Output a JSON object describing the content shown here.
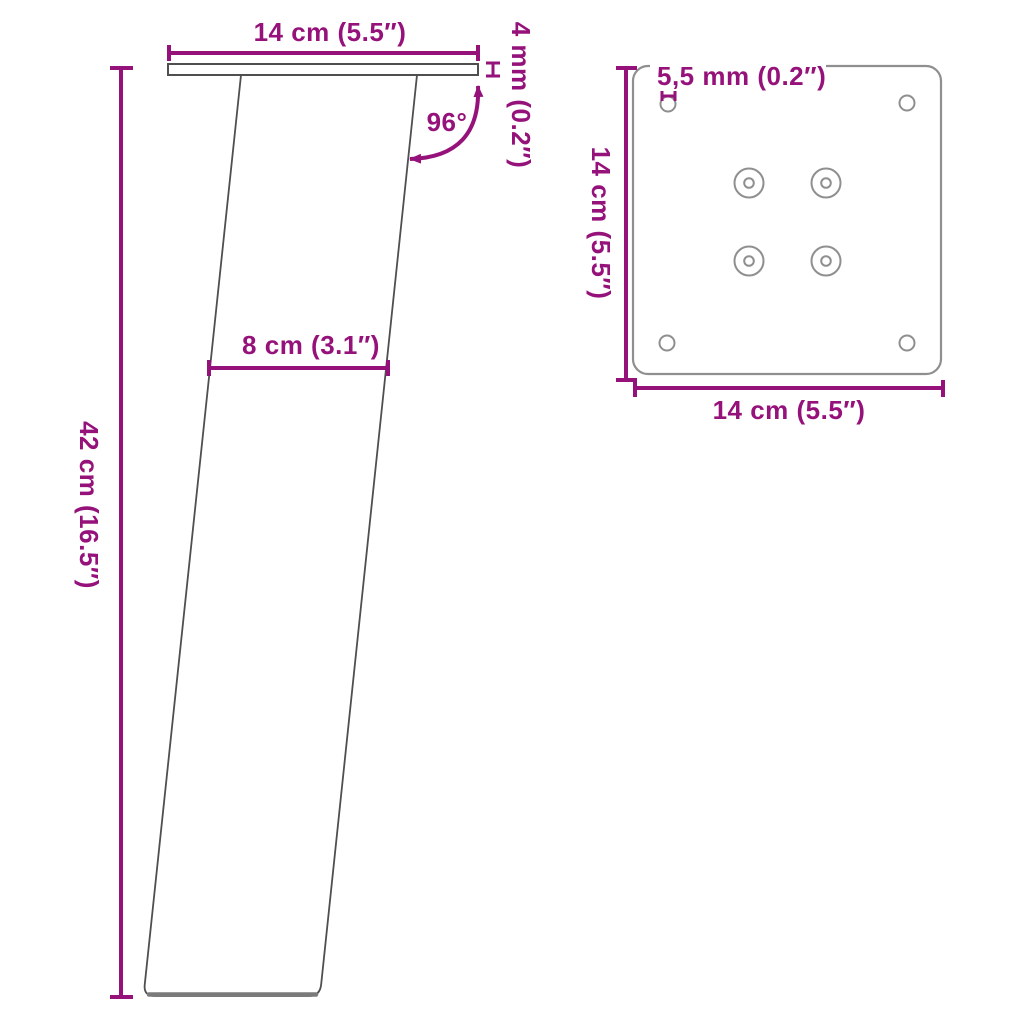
{
  "colors": {
    "accent": "#96127B",
    "outline": "#4F4F4F",
    "outline_light": "#8F8F8F",
    "foot": "#7A7A7A",
    "bg": "#FFFFFF"
  },
  "side_view": {
    "labels": {
      "top_width": "14 cm (5.5″)",
      "plate_thickness": "4 mm (0.2″)",
      "angle": "96°",
      "leg_width": "8 cm (3.1″)",
      "height": "42 cm (16.5″)"
    }
  },
  "top_view": {
    "labels": {
      "hole_diameter": "5,5 mm (0.2″)",
      "plate_depth": "14 cm (5.5″)",
      "plate_width": "14 cm (5.5″)"
    }
  }
}
